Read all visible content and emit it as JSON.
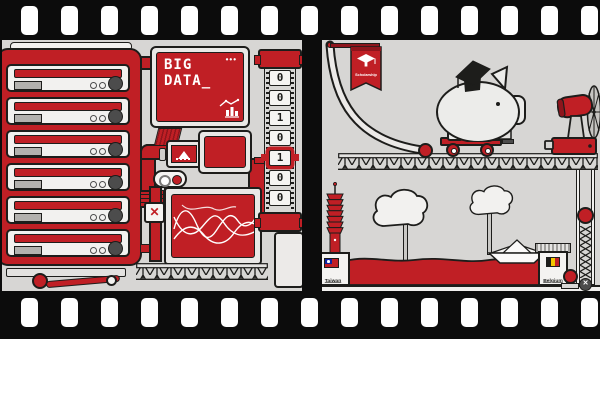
{
  "illustration": {
    "subject": "big-data-scholarship-film-strip",
    "colors": {
      "red": "#c01f25",
      "dark_red": "#8e151c",
      "outline": "#1d1d1b",
      "frame_background": "#d7d6d4",
      "film_black": "#0c0c0c",
      "belgium_yellow": "#f2c500",
      "taiwan_blue": "#10239e"
    },
    "frame1": {
      "big_data_screen": {
        "line1": "BIG",
        "line2": "DATA_",
        "menu_dots": "•••"
      },
      "server_rack": {
        "unit_count": 6
      },
      "binary_tape": {
        "cells": [
          "0",
          "0",
          "1",
          "0",
          "1",
          "0",
          "0"
        ],
        "highlighted_index": 4
      },
      "close_button_glyph": "✕"
    },
    "frame2": {
      "scholarship_flag_label": "Scholarship",
      "taiwan_label": "Taiwan",
      "belgium_label": "Belgium",
      "chain_gear_glyph": "✕"
    }
  }
}
